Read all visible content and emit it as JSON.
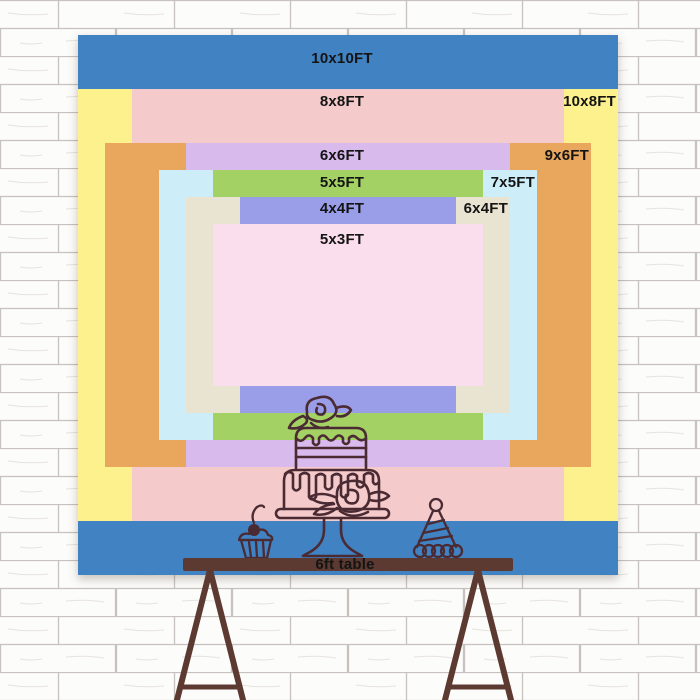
{
  "scene": {
    "wall": {
      "base_color": "#fcfcfa",
      "mortar_color": "#c7c2be"
    },
    "backdrop_layers": [
      {
        "label": "10x10FT",
        "width_ft": 10,
        "height_ft": 10,
        "color": "#4182c3"
      },
      {
        "label": "10x8FT",
        "width_ft": 10,
        "height_ft": 8,
        "color": "#fdf18d"
      },
      {
        "label": "8x8FT",
        "width_ft": 8,
        "height_ft": 8,
        "color": "#f4caca"
      },
      {
        "label": "9x6FT",
        "width_ft": 9,
        "height_ft": 6,
        "color": "#e9a75e"
      },
      {
        "label": "6x6FT",
        "width_ft": 6,
        "height_ft": 6,
        "color": "#d9baed"
      },
      {
        "label": "7x5FT",
        "width_ft": 7,
        "height_ft": 5,
        "color": "#cdeef8"
      },
      {
        "label": "5x5FT",
        "width_ft": 5,
        "height_ft": 5,
        "color": "#a4d164"
      },
      {
        "label": "6x4FT",
        "width_ft": 6,
        "height_ft": 4,
        "color": "#e9e4d1"
      },
      {
        "label": "4x4FT",
        "width_ft": 4,
        "height_ft": 4,
        "color": "#9a9ee8"
      },
      {
        "label": "5x3FT",
        "width_ft": 5,
        "height_ft": 3,
        "color": "#fbdeee"
      }
    ],
    "table": {
      "label": "6ft table",
      "color": "#5c3a31"
    },
    "line_art_color": "#4a2b33",
    "label_text_color": "#141414",
    "illustrations": [
      "cake-on-stand",
      "cupcake",
      "party-hat",
      "easel-legs"
    ]
  }
}
